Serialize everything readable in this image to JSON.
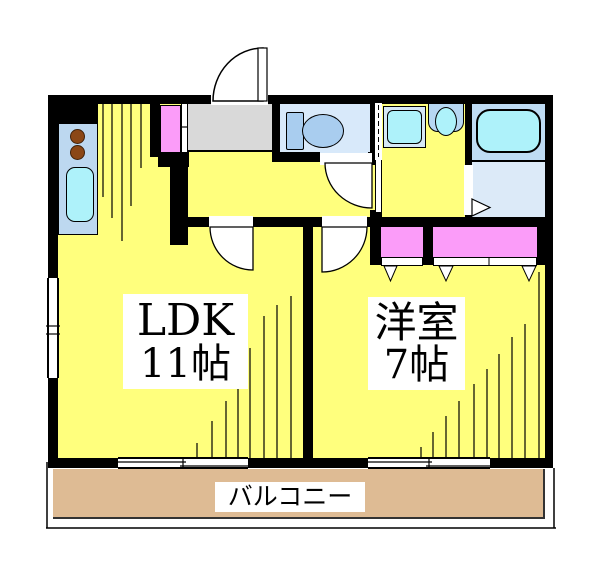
{
  "rooms": {
    "ldk": {
      "name": "LDK",
      "size": "11帖"
    },
    "western_room": {
      "name": "洋室",
      "size": "7帖"
    },
    "balcony": {
      "name": "バルコニー"
    }
  },
  "fixtures": {
    "kitchen_counter": "kitchen-counter-with-two-burners-and-sink",
    "shoe_cabinet": "shoe-cabinet",
    "entrance": "genkan-entrance",
    "toilet": "toilet-icon",
    "washing_machine_pan": "washing-machine-pan-icon",
    "wash_basin": "wash-basin-icon",
    "bathtub": "bathtub-icon",
    "closets": "closet",
    "windows": "sliding-window",
    "doors": "hinged-door-arc"
  },
  "colors": {
    "wall": "#000000",
    "floor": "#FFFF7D",
    "balcony": "#DEBB94",
    "genkan": "#D9D9D9",
    "toilet_bg": "#D8E9FA",
    "bath_bg": "#BFDCF4",
    "bath_floor": "#DCEAF8",
    "fixture_blue": "#A9CDEF",
    "counter_blue": "#BDD8F0",
    "basin_blue": "#B7D7F2",
    "pan_blue": "#D6E8F6",
    "cyan": "#AEF2FA",
    "closet_pink": "#FB9CF9",
    "burner_brown": "#8B4716"
  }
}
